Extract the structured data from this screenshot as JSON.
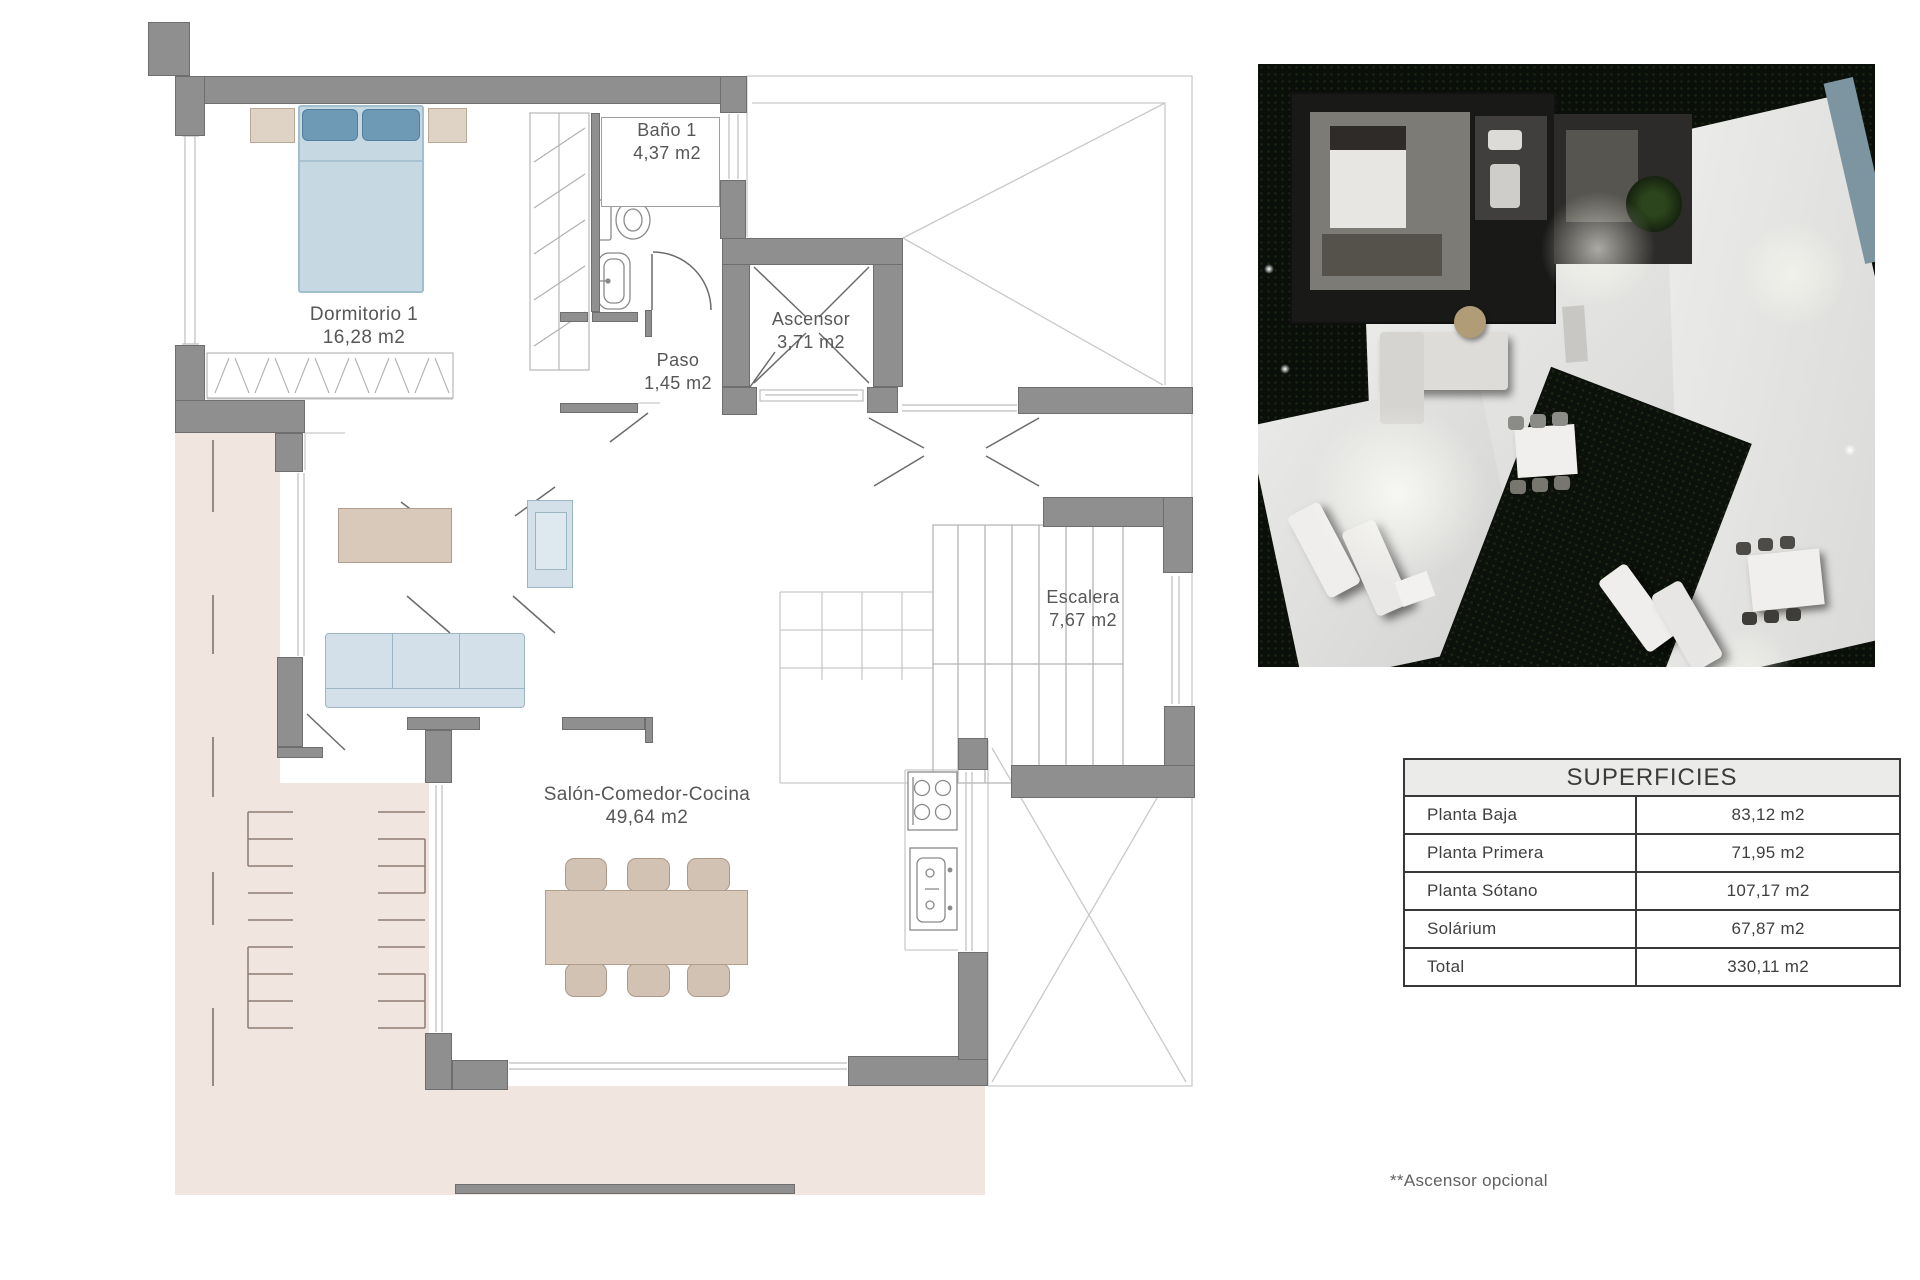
{
  "floor_plan": {
    "rooms": [
      {
        "name": "Dormitorio 1",
        "area": "16,28 m2"
      },
      {
        "name": "Baño 1",
        "area": "4,37 m2"
      },
      {
        "name": "Paso",
        "area": "1,45 m2"
      },
      {
        "name": "Ascensor",
        "area": "3,71 m2"
      },
      {
        "name": "Escalera",
        "area": "7,67 m2"
      },
      {
        "name": "Salón-Comedor-Cocina",
        "area": "49,64 m2"
      }
    ]
  },
  "superficies_table": {
    "title": "SUPERFICIES",
    "rows": [
      {
        "label": "Planta Baja",
        "value": "83,12 m2"
      },
      {
        "label": "Planta Primera",
        "value": "71,95 m2"
      },
      {
        "label": "Planta Sótano",
        "value": "107,17 m2"
      },
      {
        "label": "Solárium",
        "value": "67,87 m2"
      },
      {
        "label": "Total",
        "value": "330,11 m2"
      }
    ]
  },
  "footnote": "**Ascensor opcional",
  "colors": {
    "wall_gray": "#8f8f8f",
    "terrace_pink": "#f1e5e0",
    "furniture_blue": "#c6d9e3",
    "pillow_blue": "#6f9ab6",
    "furniture_beige": "#d8c9bb",
    "table_border": "#383838"
  }
}
